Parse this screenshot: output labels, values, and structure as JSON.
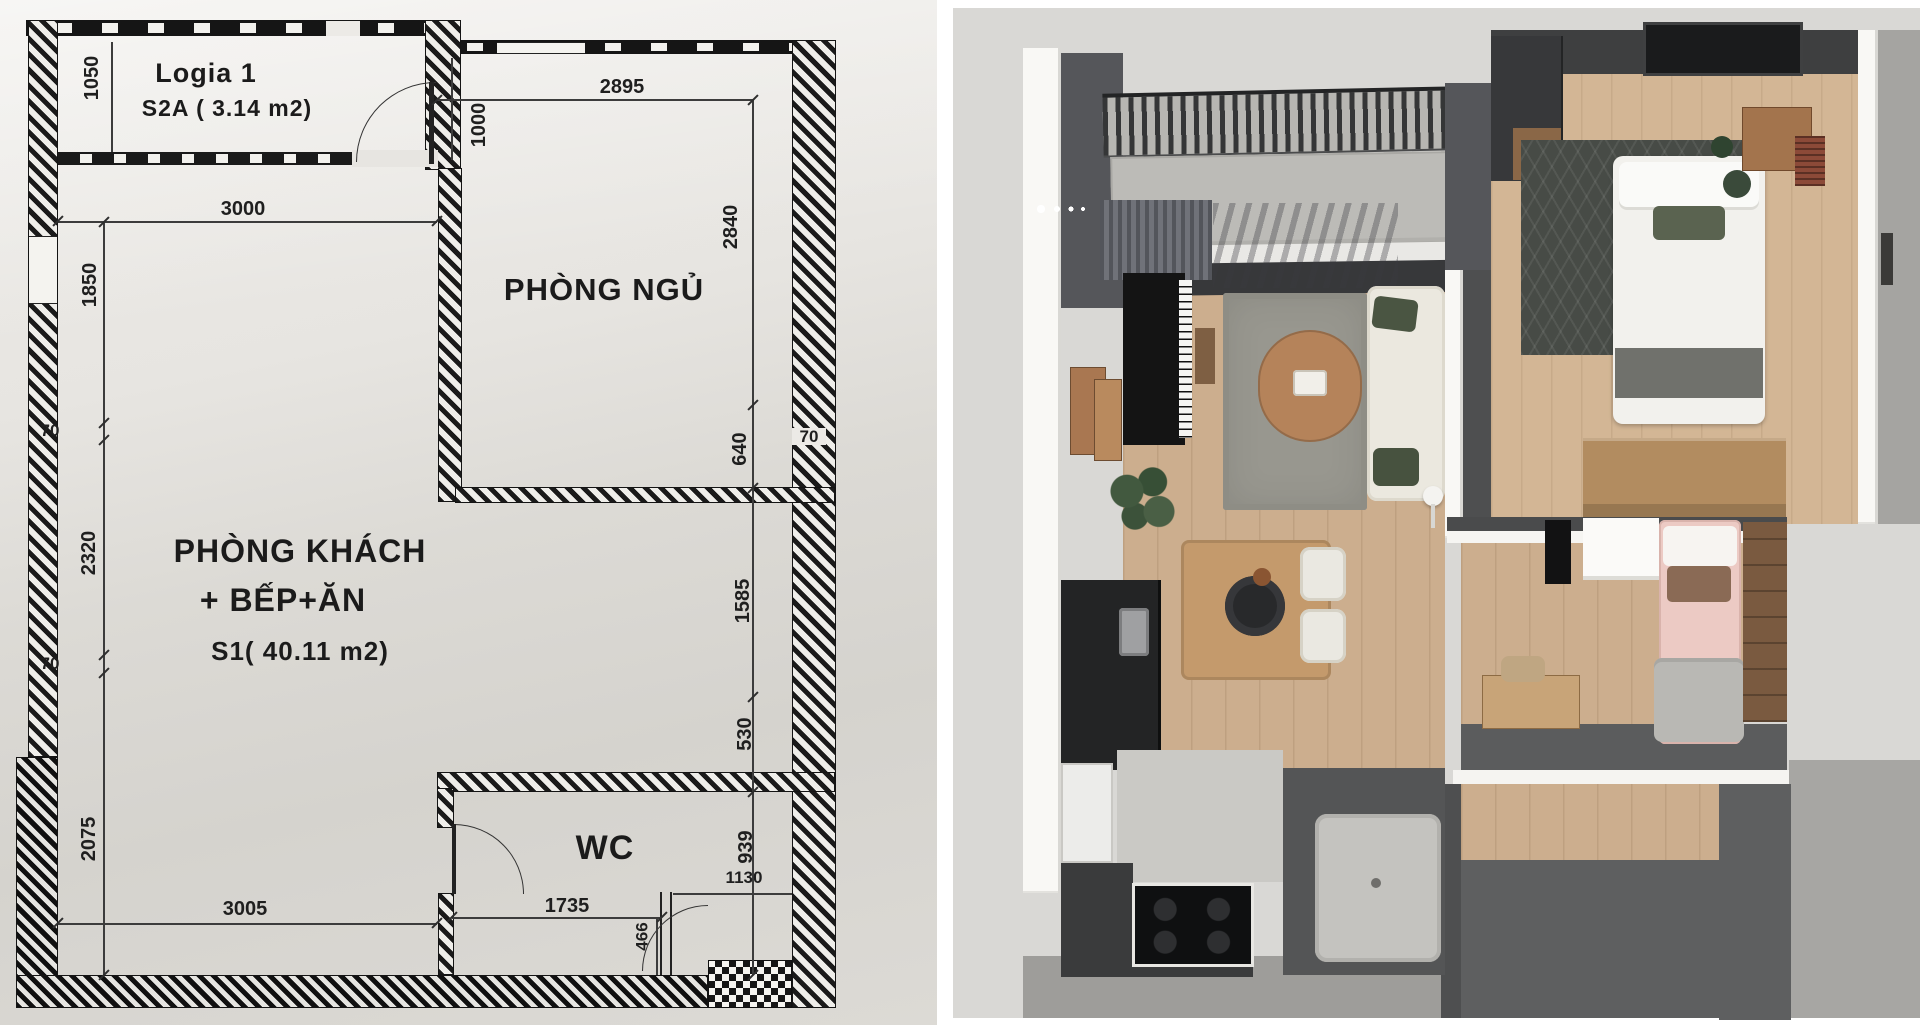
{
  "floor_plan": {
    "logia": {
      "title": "Logia 1",
      "area": "S2A ( 3.14 m2)"
    },
    "bedroom": {
      "title": "PHÒNG NGỦ"
    },
    "living": {
      "title": "PHÒNG KHÁCH",
      "title2": "+ BẾP+ĂN",
      "area": "S1( 40.11 m2)"
    },
    "wc": {
      "title": "WC"
    },
    "dims": {
      "logia_h": "1050",
      "living_top": "3000",
      "bedroom_top": "2895",
      "bedroom_door": "1000",
      "bedroom_right": "2840",
      "left_upper": "1850",
      "left_wall_a": "70",
      "left_mid": "2320",
      "left_wall_b": "70",
      "left_lower": "2075",
      "right_640": "640",
      "right_wall": "70",
      "right_1585": "1585",
      "right_530": "530",
      "right_939": "939",
      "entry_1130": "1130",
      "bottom_3005": "3005",
      "wc_1735": "1735",
      "wc_466": "466"
    },
    "ink": "#1a1a1a",
    "paper": "#e2e0db"
  },
  "render": {
    "palette": {
      "background": "#d9d8d5",
      "wall_white": "#f8f7f4",
      "wall_dark": "#55565a",
      "floor_wood": "#ccae8e",
      "rug_gray": "#98978f",
      "sofa_cream": "#ebe8df",
      "cushion_green": "#4a5542",
      "bed_pink": "#eccac4",
      "counter_dark": "#3a3b3c",
      "plant_green": "#42593f"
    }
  }
}
